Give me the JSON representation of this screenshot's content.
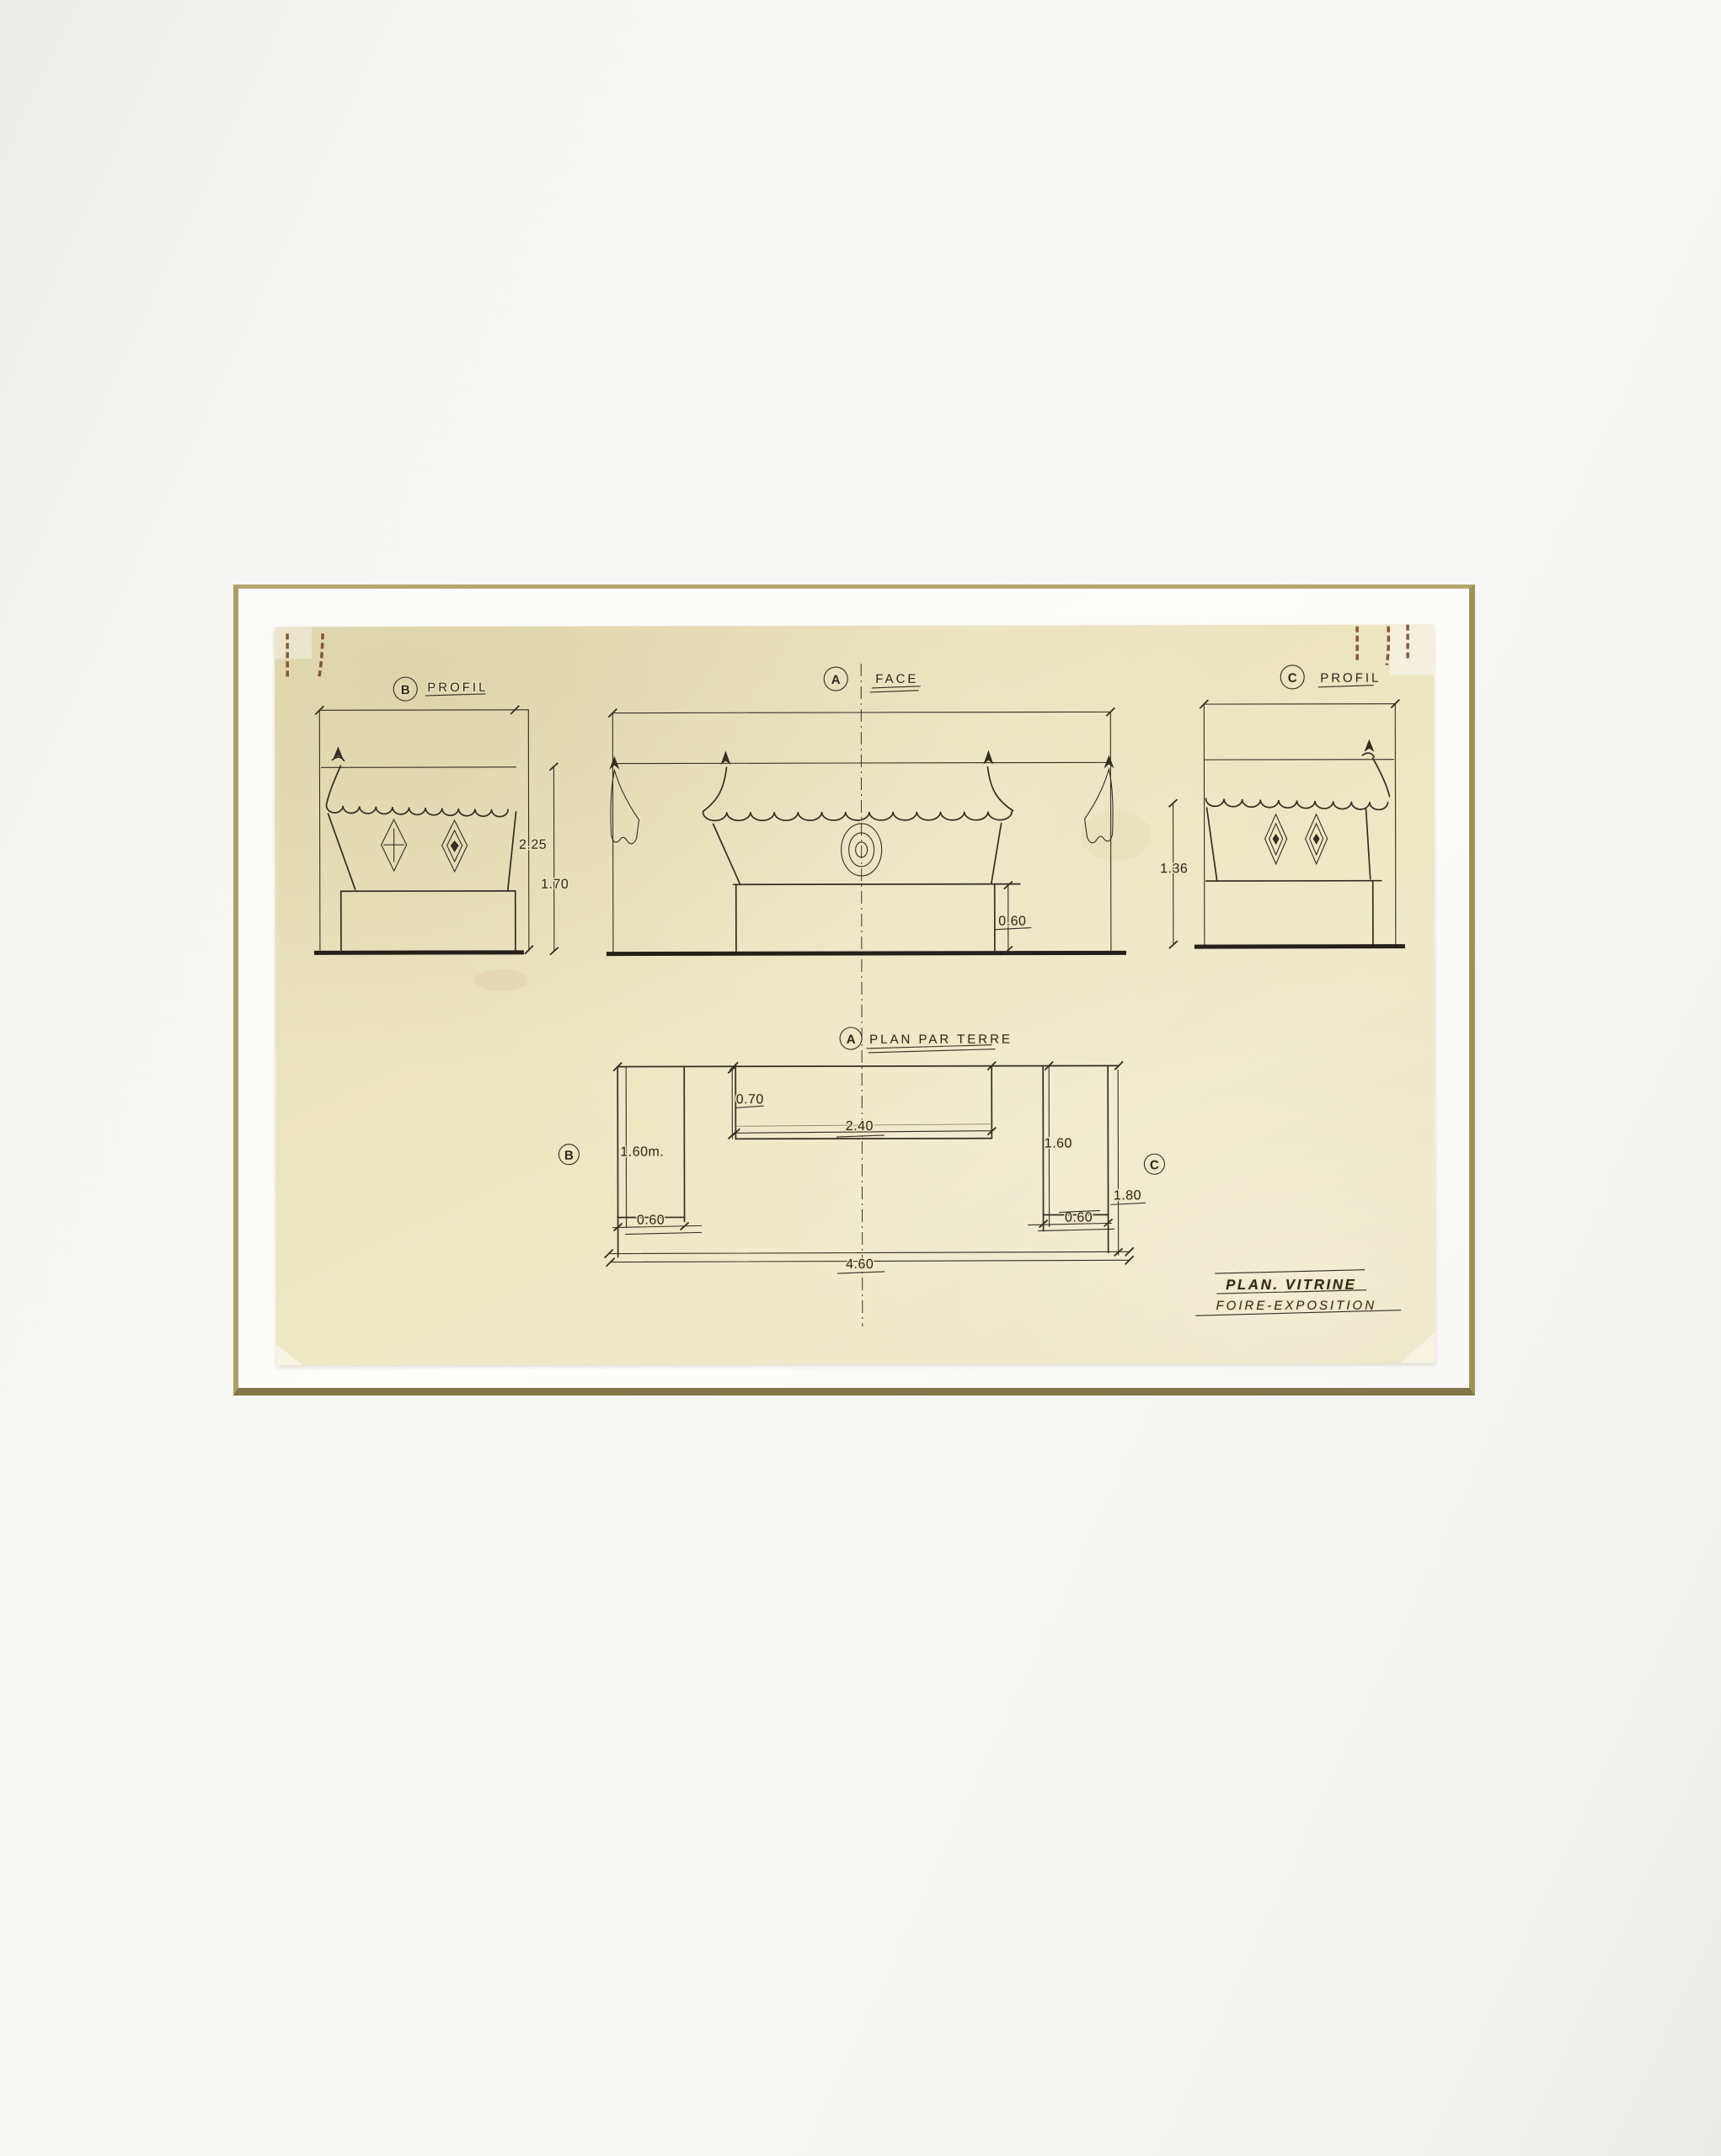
{
  "artwork": {
    "views": {
      "profil_b": {
        "letter": "B",
        "title": "PROFIL",
        "dim_total_height": "2.25",
        "dim_upper_height": "1.70"
      },
      "face_a": {
        "letter": "A",
        "title": "FACE",
        "dim_base_height": "0.60"
      },
      "profil_c": {
        "letter": "C",
        "title": "PROFIL",
        "dim_awning_height": "1.36"
      },
      "plan": {
        "letter": "A",
        "title": "PLAN PAR TERRE",
        "ref_left": "B",
        "ref_right": "C",
        "dim_left_length": "1.60m.",
        "dim_left_width": "0.60",
        "dim_center_offset": "0.70",
        "dim_center_width": "2.40",
        "dim_right_length": "1.60",
        "dim_right_width": "0.60",
        "dim_total_depth": "1.80",
        "dim_total_width": "4.60"
      }
    },
    "title_block": {
      "line1": "PLAN. VITRINE",
      "line2": "FOIRE-EXPOSITION"
    },
    "colors": {
      "ink": "#332d24",
      "paper": "#eae3bf",
      "mat_line": "#a6965f",
      "stain": "#7a3c1d",
      "background": "#f3f3f1"
    }
  }
}
